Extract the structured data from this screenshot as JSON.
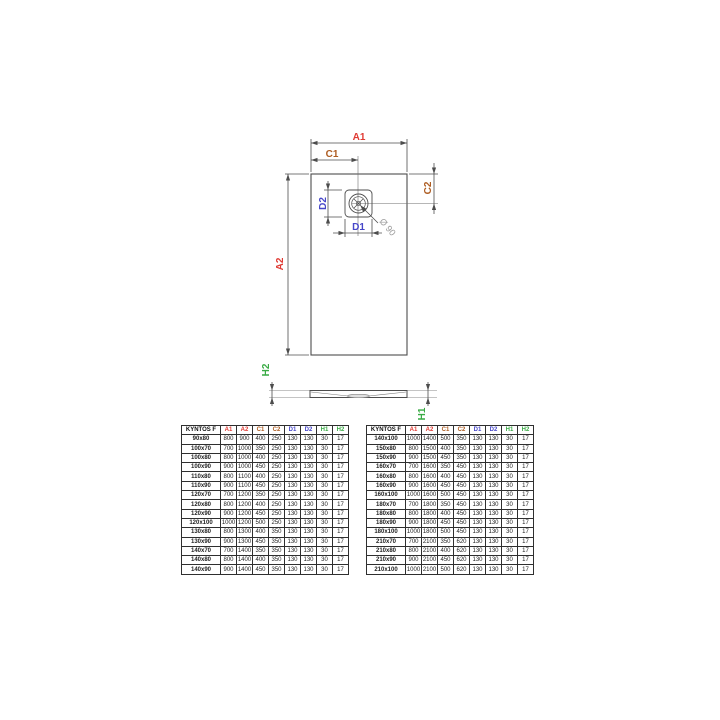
{
  "drawing": {
    "labels": {
      "a1": "A1",
      "a2": "A2",
      "c1": "C1",
      "c2": "C2",
      "d1": "D1",
      "d2": "D2",
      "h1": "H1",
      "h2": "H2",
      "drain_diameter": "Ø 90"
    },
    "colors": {
      "a": "#e03a33",
      "c": "#ad5c21",
      "d": "#4646c8",
      "h": "#3aab45",
      "diameter": "#9a9a9a",
      "line": "#4d4d4d"
    }
  },
  "tables": {
    "header": [
      {
        "label": "KYNTOS F",
        "color": "#111111"
      },
      {
        "label": "A1",
        "color": "#e03a33"
      },
      {
        "label": "A2",
        "color": "#e03a33"
      },
      {
        "label": "C1",
        "color": "#ad5c21"
      },
      {
        "label": "C2",
        "color": "#ad5c21"
      },
      {
        "label": "D1",
        "color": "#4646c8"
      },
      {
        "label": "D2",
        "color": "#4646c8"
      },
      {
        "label": "H1",
        "color": "#3aab45"
      },
      {
        "label": "H2",
        "color": "#3aab45"
      }
    ],
    "left": {
      "rows": [
        [
          "90x80",
          "800",
          "900",
          "400",
          "250",
          "130",
          "130",
          "30",
          "17"
        ],
        [
          "100x70",
          "700",
          "1000",
          "350",
          "250",
          "130",
          "130",
          "30",
          "17"
        ],
        [
          "100x80",
          "800",
          "1000",
          "400",
          "250",
          "130",
          "130",
          "30",
          "17"
        ],
        [
          "100x90",
          "900",
          "1000",
          "450",
          "250",
          "130",
          "130",
          "30",
          "17"
        ],
        [
          "110x80",
          "800",
          "1100",
          "400",
          "250",
          "130",
          "130",
          "30",
          "17"
        ],
        [
          "110x90",
          "900",
          "1100",
          "450",
          "250",
          "130",
          "130",
          "30",
          "17"
        ],
        [
          "120x70",
          "700",
          "1200",
          "350",
          "250",
          "130",
          "130",
          "30",
          "17"
        ],
        [
          "120x80",
          "800",
          "1200",
          "400",
          "250",
          "130",
          "130",
          "30",
          "17"
        ],
        [
          "120x90",
          "900",
          "1200",
          "450",
          "250",
          "130",
          "130",
          "30",
          "17"
        ],
        [
          "120x100",
          "1000",
          "1200",
          "500",
          "250",
          "130",
          "130",
          "30",
          "17"
        ],
        [
          "130x80",
          "800",
          "1300",
          "400",
          "350",
          "130",
          "130",
          "30",
          "17"
        ],
        [
          "130x90",
          "900",
          "1300",
          "450",
          "350",
          "130",
          "130",
          "30",
          "17"
        ],
        [
          "140x70",
          "700",
          "1400",
          "350",
          "350",
          "130",
          "130",
          "30",
          "17"
        ],
        [
          "140x80",
          "800",
          "1400",
          "400",
          "350",
          "130",
          "130",
          "30",
          "17"
        ],
        [
          "140x90",
          "900",
          "1400",
          "450",
          "350",
          "130",
          "130",
          "30",
          "17"
        ]
      ]
    },
    "right": {
      "rows": [
        [
          "140x100",
          "1000",
          "1400",
          "500",
          "350",
          "130",
          "130",
          "30",
          "17"
        ],
        [
          "150x80",
          "800",
          "1500",
          "400",
          "350",
          "130",
          "130",
          "30",
          "17"
        ],
        [
          "150x90",
          "900",
          "1500",
          "450",
          "350",
          "130",
          "130",
          "30",
          "17"
        ],
        [
          "160x70",
          "700",
          "1600",
          "350",
          "450",
          "130",
          "130",
          "30",
          "17"
        ],
        [
          "160x80",
          "800",
          "1600",
          "400",
          "450",
          "130",
          "130",
          "30",
          "17"
        ],
        [
          "160x90",
          "900",
          "1600",
          "450",
          "450",
          "130",
          "130",
          "30",
          "17"
        ],
        [
          "160x100",
          "1000",
          "1600",
          "500",
          "450",
          "130",
          "130",
          "30",
          "17"
        ],
        [
          "180x70",
          "700",
          "1800",
          "350",
          "450",
          "130",
          "130",
          "30",
          "17"
        ],
        [
          "180x80",
          "800",
          "1800",
          "400",
          "450",
          "130",
          "130",
          "30",
          "17"
        ],
        [
          "180x90",
          "900",
          "1800",
          "450",
          "450",
          "130",
          "130",
          "30",
          "17"
        ],
        [
          "180x100",
          "1000",
          "1800",
          "500",
          "450",
          "130",
          "130",
          "30",
          "17"
        ],
        [
          "210x70",
          "700",
          "2100",
          "350",
          "620",
          "130",
          "130",
          "30",
          "17"
        ],
        [
          "210x80",
          "800",
          "2100",
          "400",
          "620",
          "130",
          "130",
          "30",
          "17"
        ],
        [
          "210x90",
          "900",
          "2100",
          "450",
          "620",
          "130",
          "130",
          "30",
          "17"
        ],
        [
          "210x100",
          "1000",
          "2100",
          "500",
          "620",
          "130",
          "130",
          "30",
          "17"
        ]
      ]
    }
  }
}
